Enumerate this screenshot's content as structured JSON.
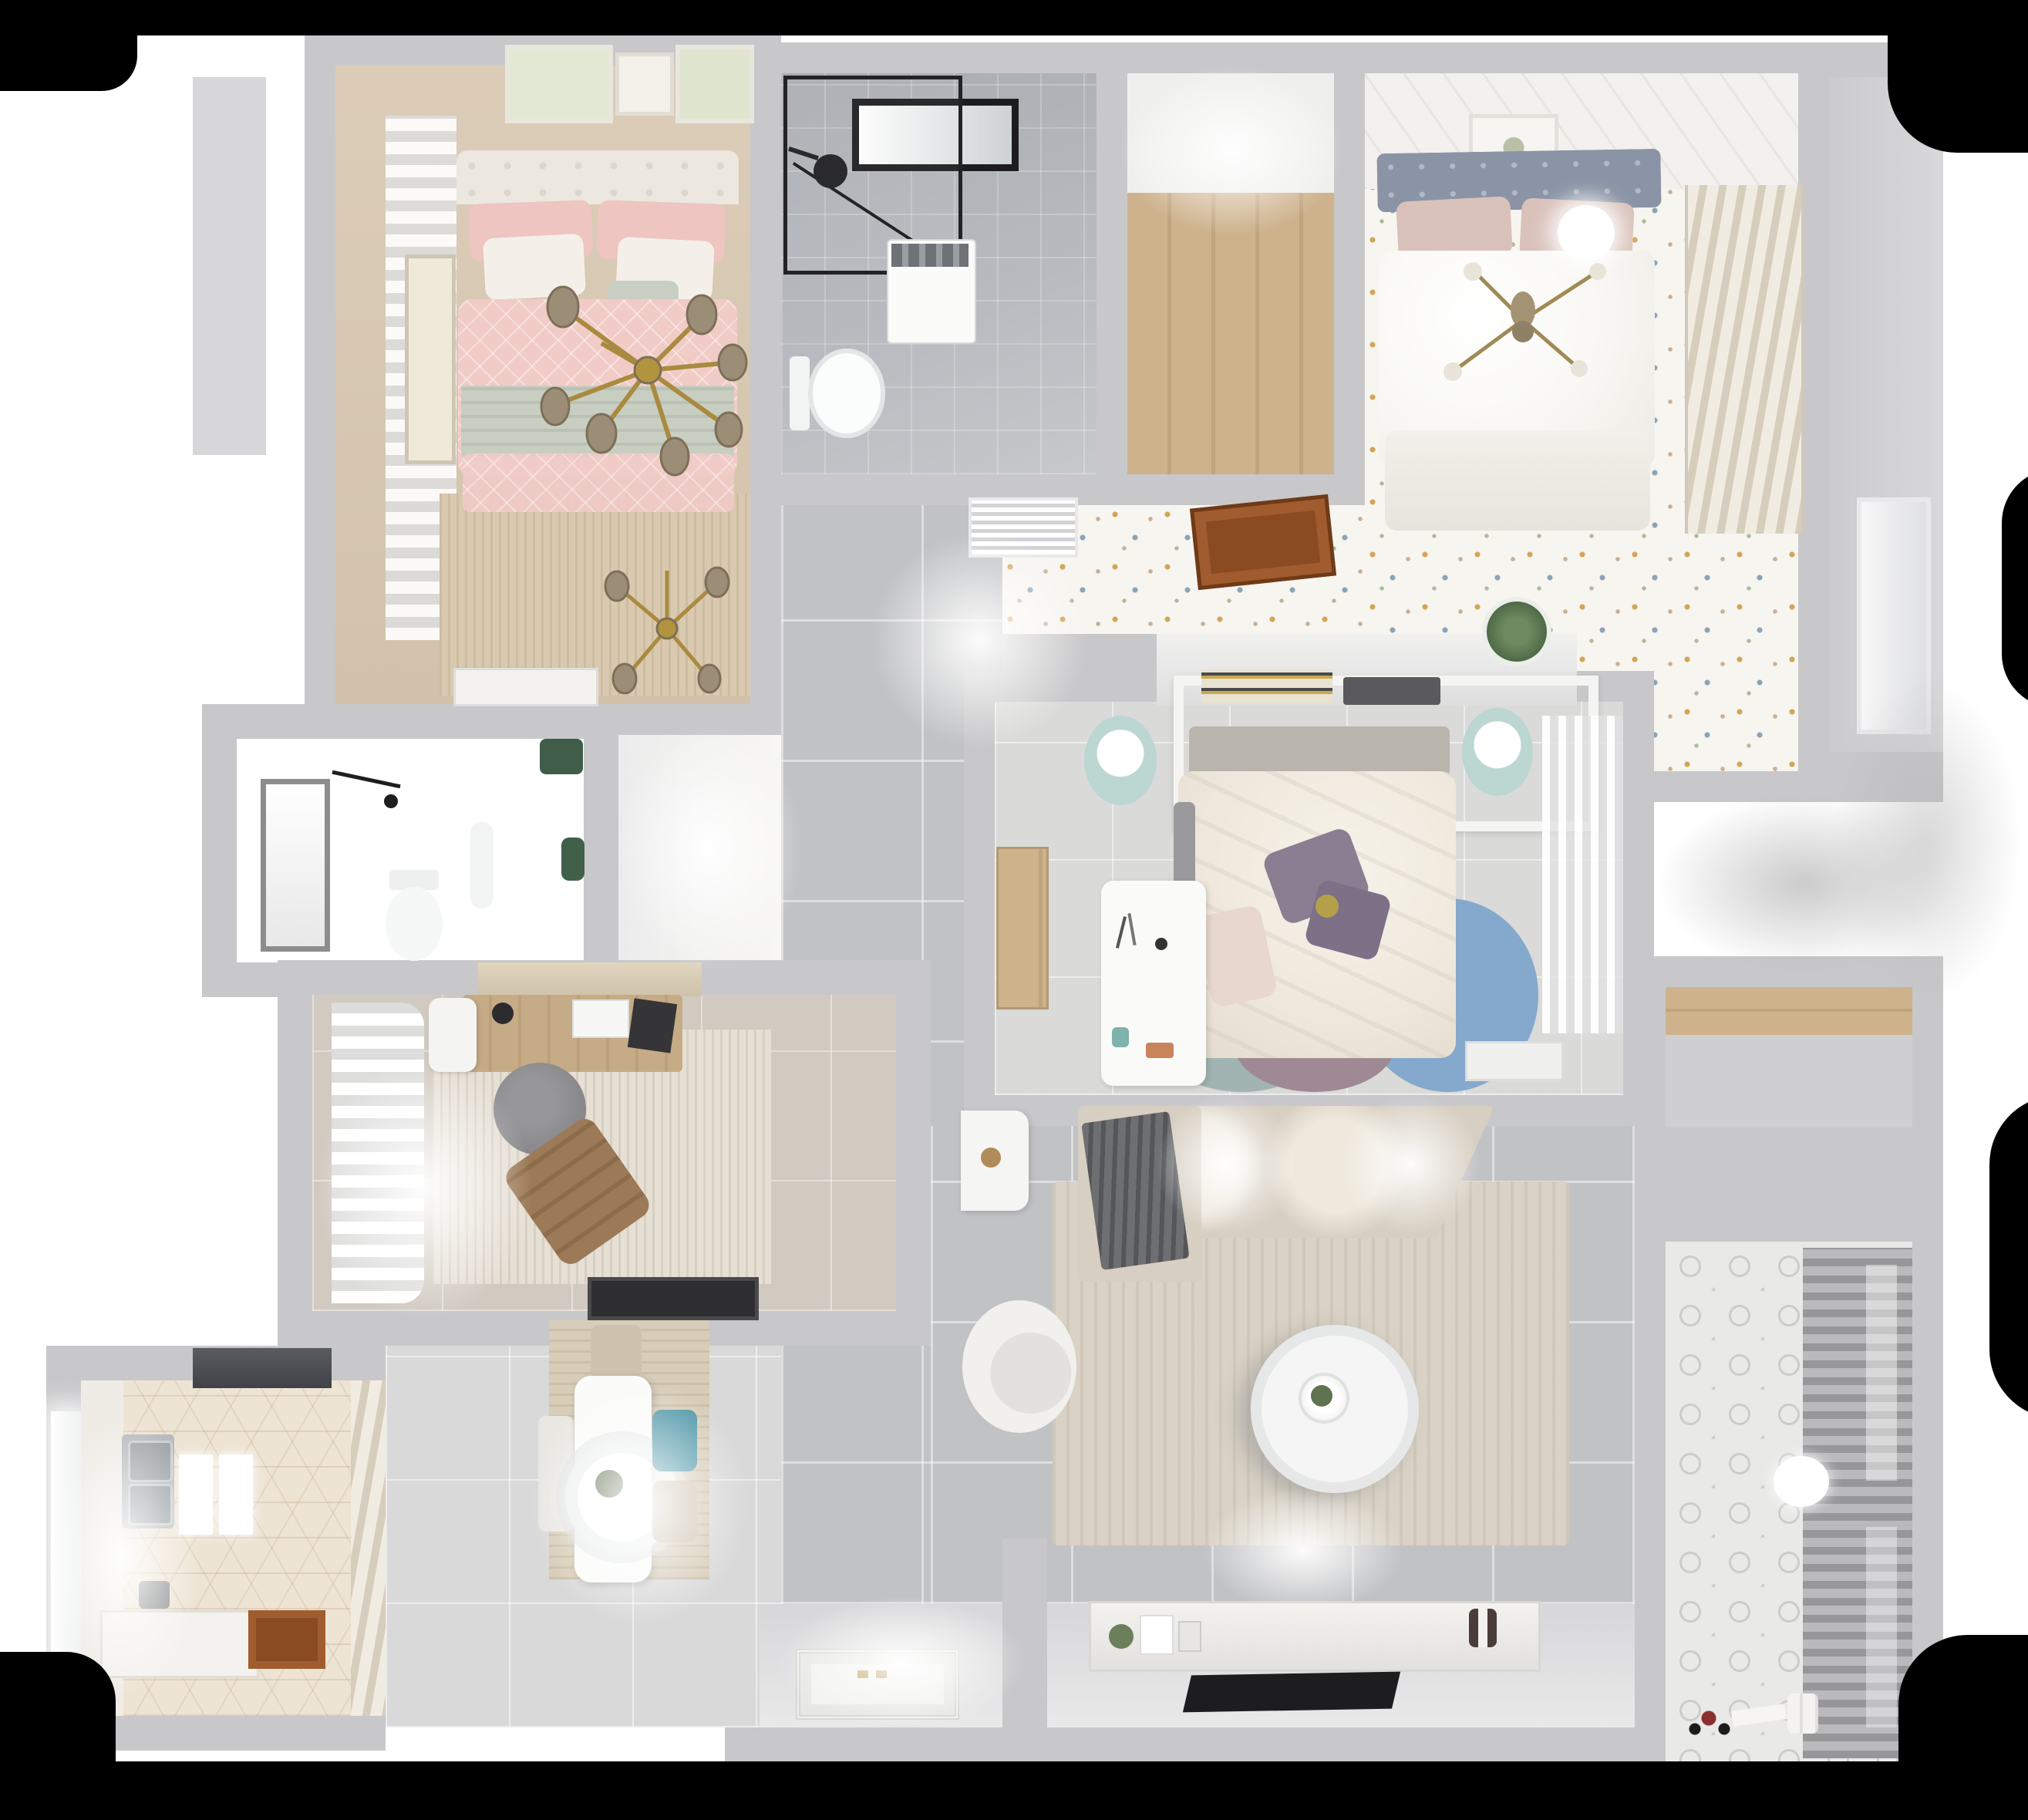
{
  "scene": {
    "kind": "floor-plan-3d-render",
    "view": "top-down"
  },
  "colors": {
    "black": "#000000",
    "wall": "#c8c8ca",
    "wallLight": "#d8d8da",
    "floorTile": "#c1c2c4",
    "floorLight": "#d9d9da",
    "confettiBase": "#f7f5f0",
    "dotGold": "#d3a455",
    "dotBlue": "#8aa3b5",
    "dotTan": "#c8b097",
    "dotSage": "#aebb9d",
    "woodFloor": "#cdb28c",
    "woodDoor": "#8a4a22",
    "woodDoorPanel": "#a05c2e",
    "pink": "#f1cbc6",
    "pinkPillow": "#eec5c0",
    "sage": "#c8cfc2",
    "ivory": "#eee7db",
    "bathTile": "#b8bbbf",
    "darkBath": "#4c4f51",
    "slateHeadboard": "#8a94a6",
    "blushPillow": "#d9c2ba",
    "masterDuvet": "#f8f7f3",
    "louver": "#d6cdbc",
    "mintLamp": "#bcd6d2",
    "purplePillow": "#8b7d92",
    "rugTeal": "#a2b4b1",
    "rugBlue": "#84a9cc",
    "rugMauve": "#9f8a93",
    "studyRug": "#e6dfd4",
    "deskWood": "#c6ab87",
    "grayChair": "#87878a",
    "brownChair": "#9c7a57",
    "hexBase": "#eee4d4",
    "steel": "#b9bcbf",
    "diningRug": "#d7cdb8",
    "tealChair": "#4e96a7",
    "beigeChair": "#cfc3b0",
    "sofa": "#d7cfc2",
    "livingRug": "#d9d2c5",
    "throwGray": "#6e6f71",
    "balcTile": "#e9e9e7",
    "rackDark": "#97979a",
    "tv": "#1d1d1f",
    "gold": "#b08c3a",
    "plantGreen": "#4e6b48",
    "matWhite": "#f2f2f0"
  },
  "rooms": [
    {
      "id": "bedroom-pink",
      "label": "bedroom 1",
      "floor": "wood-beige",
      "furniture": [
        "double-bed",
        "pink-duvet",
        "sage-throw",
        "pillows",
        "tufted-headboard",
        "gold-branch-chandelier",
        "gold-branch-chandelier-small",
        "beige-curtains",
        "wall-art-frames",
        "fringed-rug",
        "white-dresser"
      ]
    },
    {
      "id": "bathroom-main",
      "label": "bathroom 1",
      "floor": "gray-marble-tile",
      "furniture": [
        "walk-in-shower-glass",
        "black-shower-head",
        "black-frame-window",
        "washing-machine",
        "toilet"
      ]
    },
    {
      "id": "closet-hall",
      "label": "walk-through closet",
      "floor": "wood-laminate",
      "furniture": []
    },
    {
      "id": "bedroom-master",
      "label": "bedroom 2",
      "floor": "confetti-terrazzo",
      "furniture": [
        "double-bed",
        "slate-tufted-headboard",
        "blush-pillows",
        "white-duvet",
        "gold-cross-fan-light",
        "ceiling-light-disc",
        "louvered-wardrobe",
        "wall-art-frame",
        "exterior-door"
      ]
    },
    {
      "id": "hallway-suite",
      "label": "suite hallway",
      "floor": "confetti-terrazzo",
      "furniture": [
        "air-vent-grille",
        "open-wood-door",
        "console-half-wall",
        "potted-plant"
      ]
    },
    {
      "id": "bedroom-center",
      "label": "bedroom 3",
      "floor": "light-tile",
      "furniture": [
        "canopy-bed",
        "ivory-duvet",
        "purple-pillows",
        "headboard-shelf-books",
        "nightstand-lamp-left",
        "nightstand-lamp-right",
        "white-desk",
        "wood-sideboard",
        "circle-rug-teal",
        "circle-rug-blue",
        "circle-rug-mauve",
        "sheer-wardrobe",
        "bench"
      ]
    },
    {
      "id": "bathroom-dark",
      "label": "bathroom 2",
      "floor": "dark-marble",
      "furniture": [
        "window",
        "shower-fixture",
        "toilet",
        "pedestal-sink",
        "green-plant-accents"
      ]
    },
    {
      "id": "study",
      "label": "study",
      "floor": "beige-tile",
      "furniture": [
        "writing-desk",
        "white-chair",
        "desk-lamp",
        "laptop",
        "gray-round-chair",
        "brown-lounge-chair",
        "distressed-rug",
        "white-pleated-curtains",
        "valance",
        "black-doormat"
      ]
    },
    {
      "id": "kitchen",
      "label": "kitchen",
      "floor": "hex-tile",
      "furniture": [
        "range-hood",
        "double-sink",
        "counters",
        "cutting-boards",
        "window",
        "open-wood-door",
        "louvered-pantry"
      ]
    },
    {
      "id": "dining",
      "label": "dining area",
      "floor": "light-tile",
      "furniture": [
        "white-dining-table",
        "ring-pendant-lamp",
        "beige-chair",
        "teal-chair",
        "beige-chair-2",
        "white-chair",
        "wood-grain-rug"
      ]
    },
    {
      "id": "living",
      "label": "living room",
      "floor": "gray-tile",
      "furniture": [
        "sectional-sofa",
        "gray-throw",
        "area-rug",
        "round-coffee-table",
        "accent-chair",
        "side-table",
        "tv-console",
        "flat-tv",
        "console-decor"
      ]
    },
    {
      "id": "entry",
      "label": "entry hall",
      "floor": "white-tile",
      "furniture": [
        "ornate-door-mat"
      ]
    },
    {
      "id": "balcony",
      "label": "balcony / laundry",
      "floor": "patterned-cement-tile",
      "furniture": [
        "drying-rack-panel",
        "ball-lamp",
        "storage-niche-wood-shelf",
        "toy-car",
        "detergent-bottles"
      ]
    }
  ]
}
